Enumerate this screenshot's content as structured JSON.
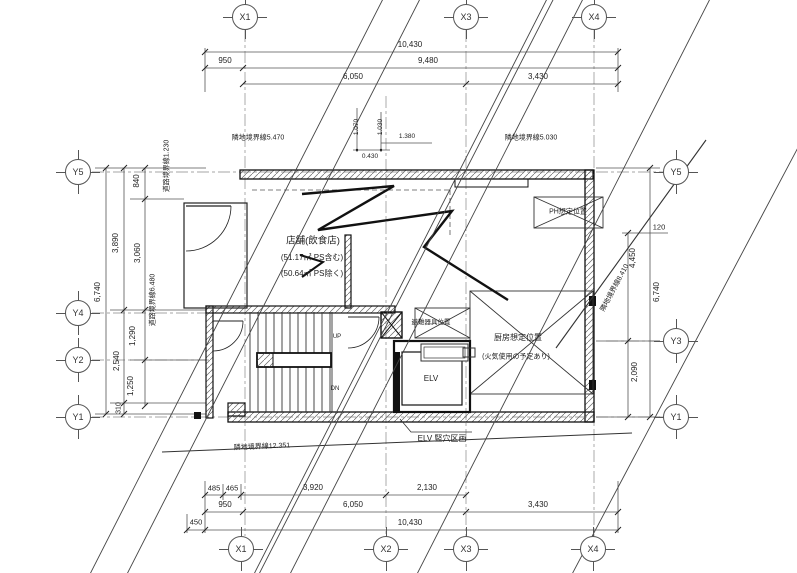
{
  "grid_labels": {
    "top": [
      "X1",
      "X3",
      "X4"
    ],
    "bottom": [
      "X1",
      "X2",
      "X3",
      "X4"
    ],
    "left": [
      "Y5",
      "Y4",
      "Y2",
      "Y1"
    ],
    "right": [
      "Y5",
      "Y3",
      "Y1"
    ]
  },
  "dimensions": {
    "top": {
      "overall": "10,430",
      "offset": "950",
      "span": "9,480",
      "x1_x3": "6,050",
      "x3_x4": "3,430"
    },
    "top_small": {
      "a": "1.070",
      "b": "1.030",
      "c": "0.430",
      "d": "1.380"
    },
    "bottom": {
      "seg1": "485",
      "seg2": "465",
      "seg3": "3,920",
      "seg4": "2,130",
      "offset": "950",
      "x1_x3": "6,050",
      "x3_x4": "3,430",
      "edge": "450",
      "overall": "10,430"
    },
    "left": {
      "overall": "6,740",
      "upper": "3,890",
      "mid": "2,540",
      "lower": "310",
      "seg1": "840",
      "seg2": "3,060",
      "seg3": "1,290",
      "seg4": "1,250"
    },
    "right": {
      "offset": "120",
      "upper": "4,450",
      "overall": "6,740",
      "lower": "2,090"
    }
  },
  "boundary_labels": {
    "top_left": "隣地境界線5.470",
    "top_right": "隣地境界線5.030",
    "left_upper": "道路境界線1.230",
    "left_lower": "道路境界線6.480",
    "right": "隣地境界線8.410",
    "bottom": "隣地境界線12.351"
  },
  "plan_labels": {
    "store": "店舗(飲食店)",
    "store_area_incl": "(51.17㎡ PS含む)",
    "store_area_excl": "(50.64㎡ PS除く)",
    "kitchen": "厨房想定位置",
    "kitchen_note": "(火気使用の予定あり)",
    "ph": "PH想定位置",
    "evacuation": "避難器具位置",
    "elevator": "ELV",
    "elevator_note": "ELV 竪穴区画",
    "up": "UP",
    "down": "DN"
  }
}
